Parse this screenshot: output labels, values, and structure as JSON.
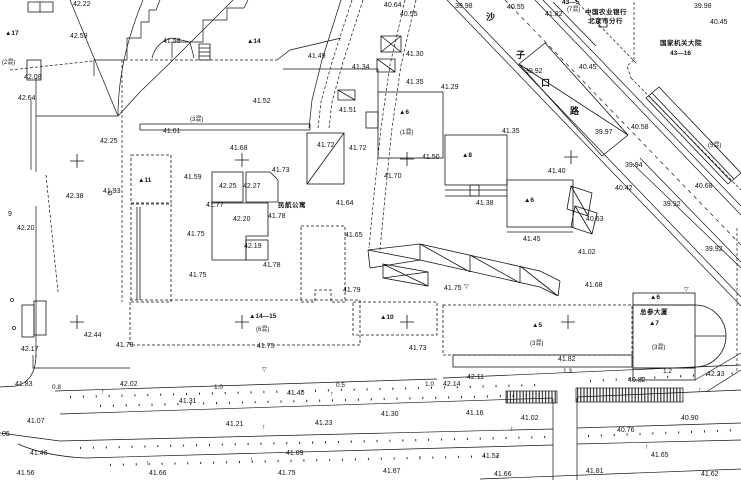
{
  "document": {
    "kind": "topographic-survey-drawing",
    "background_color": "#ffffff",
    "line_color": "#141414"
  },
  "names": {
    "bank_line1": "中国农业银行",
    "bank_line2": "北京市分行",
    "gov_compound": "国家机关大院",
    "gov_compound_no": "43—16",
    "apartment": "民航公寓",
    "tower": "总参大厦",
    "street_chars": [
      "沙",
      "子",
      "口",
      "路"
    ]
  },
  "labels": [
    {
      "t": "42.22",
      "x": 73,
      "y": 1,
      "c": "elev"
    },
    {
      "t": "42.59",
      "x": 70,
      "y": 33,
      "c": "elev"
    },
    {
      "t": "41.59",
      "x": 163,
      "y": 38,
      "c": "elev"
    },
    {
      "t": "42.08",
      "x": 24,
      "y": 74,
      "c": "elev"
    },
    {
      "t": "42.64",
      "x": 18,
      "y": 95,
      "c": "elev"
    },
    {
      "t": "42.25",
      "x": 100,
      "y": 138,
      "c": "elev"
    },
    {
      "t": "41.61",
      "x": 163,
      "y": 128,
      "c": "elev"
    },
    {
      "t": "42.38",
      "x": 66,
      "y": 193,
      "c": "elev"
    },
    {
      "t": "41.93",
      "x": 103,
      "y": 188,
      "c": "elev"
    },
    {
      "t": "42.20",
      "x": 17,
      "y": 225,
      "c": "elev"
    },
    {
      "t": "9",
      "x": 8,
      "y": 211,
      "c": "elev"
    },
    {
      "t": "41.68",
      "x": 230,
      "y": 145,
      "c": "elev"
    },
    {
      "t": "41.59",
      "x": 184,
      "y": 174,
      "c": "elev"
    },
    {
      "t": "41.73",
      "x": 272,
      "y": 167,
      "c": "elev"
    },
    {
      "t": "42.25",
      "x": 219,
      "y": 183,
      "c": "elev"
    },
    {
      "t": "42.27",
      "x": 243,
      "y": 183,
      "c": "elev"
    },
    {
      "t": "41.77",
      "x": 206,
      "y": 202,
      "c": "elev"
    },
    {
      "t": "42.20",
      "x": 233,
      "y": 216,
      "c": "elev"
    },
    {
      "t": "41.78",
      "x": 268,
      "y": 213,
      "c": "elev"
    },
    {
      "t": "41.75",
      "x": 187,
      "y": 231,
      "c": "elev"
    },
    {
      "t": "42.19",
      "x": 244,
      "y": 243,
      "c": "elev"
    },
    {
      "t": "41.78",
      "x": 263,
      "y": 262,
      "c": "elev"
    },
    {
      "t": "41.75",
      "x": 189,
      "y": 272,
      "c": "elev"
    },
    {
      "t": "41.64",
      "x": 336,
      "y": 200,
      "c": "elev"
    },
    {
      "t": "41.65",
      "x": 345,
      "y": 232,
      "c": "elev"
    },
    {
      "t": "41.79",
      "x": 343,
      "y": 287,
      "c": "elev"
    },
    {
      "t": "41.72",
      "x": 317,
      "y": 142,
      "c": "elev"
    },
    {
      "t": "41.72",
      "x": 349,
      "y": 145,
      "c": "elev"
    },
    {
      "t": "41.49",
      "x": 308,
      "y": 53,
      "c": "elev"
    },
    {
      "t": "41.52",
      "x": 253,
      "y": 98,
      "c": "elev"
    },
    {
      "t": "41.51",
      "x": 339,
      "y": 107,
      "c": "elev"
    },
    {
      "t": "41.34",
      "x": 352,
      "y": 64,
      "c": "elev"
    },
    {
      "t": "40.64",
      "x": 384,
      "y": 2,
      "c": "elev"
    },
    {
      "t": "40.55",
      "x": 400,
      "y": 11,
      "c": "elev"
    },
    {
      "t": "40.55",
      "x": 507,
      "y": 4,
      "c": "elev"
    },
    {
      "t": "41.82",
      "x": 545,
      "y": 11,
      "c": "elev"
    },
    {
      "t": "41.30",
      "x": 406,
      "y": 51,
      "c": "elev"
    },
    {
      "t": "41.35",
      "x": 406,
      "y": 79,
      "c": "elev"
    },
    {
      "t": "41.29",
      "x": 441,
      "y": 84,
      "c": "elev"
    },
    {
      "t": "41.35",
      "x": 502,
      "y": 128,
      "c": "elev"
    },
    {
      "t": "39.92",
      "x": 525,
      "y": 68,
      "c": "elev"
    },
    {
      "t": "39.98",
      "x": 455,
      "y": 3,
      "c": "elev"
    },
    {
      "t": "39.98",
      "x": 694,
      "y": 3,
      "c": "elev"
    },
    {
      "t": "40.45",
      "x": 579,
      "y": 64,
      "c": "elev"
    },
    {
      "t": "40.45",
      "x": 710,
      "y": 19,
      "c": "elev"
    },
    {
      "t": "39.97",
      "x": 595,
      "y": 129,
      "c": "elev"
    },
    {
      "t": "39.94",
      "x": 625,
      "y": 162,
      "c": "elev"
    },
    {
      "t": "40.58",
      "x": 631,
      "y": 124,
      "c": "elev"
    },
    {
      "t": "40.42",
      "x": 615,
      "y": 185,
      "c": "elev"
    },
    {
      "t": "40.63",
      "x": 586,
      "y": 216,
      "c": "elev"
    },
    {
      "t": "39.92",
      "x": 663,
      "y": 201,
      "c": "elev"
    },
    {
      "t": "39.92",
      "x": 705,
      "y": 246,
      "c": "elev"
    },
    {
      "t": "40.68",
      "x": 695,
      "y": 183,
      "c": "elev"
    },
    {
      "t": "41.02",
      "x": 578,
      "y": 249,
      "c": "elev"
    },
    {
      "t": "41.68",
      "x": 585,
      "y": 282,
      "c": "elev"
    },
    {
      "t": "41.50",
      "x": 422,
      "y": 154,
      "c": "elev"
    },
    {
      "t": "41.38",
      "x": 476,
      "y": 200,
      "c": "elev"
    },
    {
      "t": "41.40",
      "x": 548,
      "y": 168,
      "c": "elev"
    },
    {
      "t": "41.45",
      "x": 523,
      "y": 236,
      "c": "elev"
    },
    {
      "t": "41.75",
      "x": 444,
      "y": 285,
      "c": "elev"
    },
    {
      "t": "41.70",
      "x": 384,
      "y": 173,
      "c": "elev"
    },
    {
      "t": "42.17",
      "x": 21,
      "y": 346,
      "c": "elev"
    },
    {
      "t": "42.44",
      "x": 84,
      "y": 332,
      "c": "elev"
    },
    {
      "t": "41.78",
      "x": 116,
      "y": 342,
      "c": "elev"
    },
    {
      "t": "41.75",
      "x": 257,
      "y": 343,
      "c": "elev"
    },
    {
      "t": "41.73",
      "x": 409,
      "y": 345,
      "c": "elev"
    },
    {
      "t": "41.82",
      "x": 558,
      "y": 356,
      "c": "elev"
    },
    {
      "t": "41.83",
      "x": 15,
      "y": 381,
      "c": "elev"
    },
    {
      "t": "42.02",
      "x": 120,
      "y": 381,
      "c": "elev"
    },
    {
      "t": "41.31",
      "x": 179,
      "y": 398,
      "c": "elev"
    },
    {
      "t": "41.07",
      "x": 27,
      "y": 418,
      "c": "elev"
    },
    {
      "t": "41.21",
      "x": 226,
      "y": 421,
      "c": "elev"
    },
    {
      "t": "41.23",
      "x": 315,
      "y": 420,
      "c": "elev"
    },
    {
      "t": "41.40",
      "x": 287,
      "y": 390,
      "c": "elev"
    },
    {
      "t": "41.30",
      "x": 381,
      "y": 411,
      "c": "elev"
    },
    {
      "t": "41.16",
      "x": 466,
      "y": 410,
      "c": "elev"
    },
    {
      "t": "42.14",
      "x": 443,
      "y": 381,
      "c": "elev"
    },
    {
      "t": "42.11",
      "x": 467,
      "y": 374,
      "c": "elev"
    },
    {
      "t": "40.82",
      "x": 628,
      "y": 377,
      "c": "elev"
    },
    {
      "t": "42.23",
      "x": 707,
      "y": 371,
      "c": "elev"
    },
    {
      "t": "41.02",
      "x": 521,
      "y": 415,
      "c": "elev"
    },
    {
      "t": "40.90",
      "x": 681,
      "y": 415,
      "c": "elev"
    },
    {
      "t": "40.76",
      "x": 617,
      "y": 427,
      "c": "elev"
    },
    {
      "t": "41.46",
      "x": 30,
      "y": 450,
      "c": "elev"
    },
    {
      "t": "41.89",
      "x": 286,
      "y": 450,
      "c": "elev"
    },
    {
      "t": "41.56",
      "x": 17,
      "y": 470,
      "c": "elev"
    },
    {
      "t": "41.66",
      "x": 149,
      "y": 470,
      "c": "elev"
    },
    {
      "t": "41.75",
      "x": 278,
      "y": 470,
      "c": "elev"
    },
    {
      "t": "41.87",
      "x": 383,
      "y": 468,
      "c": "elev"
    },
    {
      "t": "41.52",
      "x": 482,
      "y": 453,
      "c": "elev"
    },
    {
      "t": "41.65",
      "x": 651,
      "y": 452,
      "c": "elev"
    },
    {
      "t": "41.66",
      "x": 494,
      "y": 471,
      "c": "elev"
    },
    {
      "t": "41.81",
      "x": 586,
      "y": 468,
      "c": "elev"
    },
    {
      "t": "41.62",
      "x": 701,
      "y": 471,
      "c": "elev"
    },
    {
      "t": ".05",
      "x": 0,
      "y": 431,
      "c": "elev"
    },
    {
      "t": "▲17",
      "x": 5,
      "y": 31,
      "c": "bld"
    },
    {
      "t": "▲14",
      "x": 247,
      "y": 39,
      "c": "bld"
    },
    {
      "t": "▲11",
      "x": 138,
      "y": 178,
      "c": "bld"
    },
    {
      "t": "▲14—15",
      "x": 249,
      "y": 314,
      "c": "bld"
    },
    {
      "t": "▲10",
      "x": 380,
      "y": 315,
      "c": "bld"
    },
    {
      "t": "▲5",
      "x": 532,
      "y": 323,
      "c": "bld"
    },
    {
      "t": "▲6",
      "x": 399,
      "y": 110,
      "c": "bld"
    },
    {
      "t": "▲8",
      "x": 462,
      "y": 153,
      "c": "bld"
    },
    {
      "t": "▲6",
      "x": 524,
      "y": 198,
      "c": "bld"
    },
    {
      "t": "▲7",
      "x": 649,
      "y": 321,
      "c": "bld"
    },
    {
      "t": "▲6",
      "x": 650,
      "y": 295,
      "c": "bld"
    },
    {
      "t": "43—5",
      "x": 562,
      "y": 0,
      "c": "bld"
    },
    {
      "t": "43—16",
      "x": 670,
      "y": 51,
      "c": "bld"
    },
    {
      "t": "(2混)",
      "x": 2,
      "y": 60,
      "c": "ann"
    },
    {
      "t": "(3混)",
      "x": 190,
      "y": 117,
      "c": "ann"
    },
    {
      "t": "(6混)",
      "x": 256,
      "y": 327,
      "c": "ann"
    },
    {
      "t": "(1混)",
      "x": 400,
      "y": 130,
      "c": "ann"
    },
    {
      "t": "(7混)",
      "x": 567,
      "y": 7,
      "c": "ann"
    },
    {
      "t": "(5混)",
      "x": 708,
      "y": 143,
      "c": "ann"
    },
    {
      "t": "(3混)",
      "x": 530,
      "y": 341,
      "c": "ann"
    },
    {
      "t": "(3混)",
      "x": 652,
      "y": 345,
      "c": "ann"
    },
    {
      "t": "中国农业银行",
      "x": 585,
      "y": 10,
      "c": "name"
    },
    {
      "t": "北京市分行",
      "x": 588,
      "y": 19,
      "c": "name"
    },
    {
      "t": "国家机关大院",
      "x": 660,
      "y": 41,
      "c": "name"
    },
    {
      "t": "民航公寓",
      "x": 278,
      "y": 203,
      "c": "name"
    },
    {
      "t": "总参大厦",
      "x": 640,
      "y": 310,
      "c": "name"
    },
    {
      "t": "沙",
      "x": 486,
      "y": 13,
      "c": "street"
    },
    {
      "t": "子",
      "x": 516,
      "y": 51,
      "c": "street"
    },
    {
      "t": "口",
      "x": 541,
      "y": 79,
      "c": "street"
    },
    {
      "t": "路",
      "x": 570,
      "y": 107,
      "c": "street"
    },
    {
      "t": "0.8",
      "x": 52,
      "y": 385,
      "c": "dim"
    },
    {
      "t": "1.0",
      "x": 214,
      "y": 385,
      "c": "dim"
    },
    {
      "t": "0.5",
      "x": 336,
      "y": 383,
      "c": "dim"
    },
    {
      "t": "1.0",
      "x": 425,
      "y": 382,
      "c": "dim"
    },
    {
      "t": "1.3",
      "x": 563,
      "y": 369,
      "c": "dim"
    },
    {
      "t": "1.2",
      "x": 663,
      "y": 369,
      "c": "dim"
    },
    {
      "t": "▽",
      "x": 464,
      "y": 284,
      "c": "sym"
    },
    {
      "t": "▽",
      "x": 684,
      "y": 287,
      "c": "sym"
    },
    {
      "t": "▽",
      "x": 262,
      "y": 367,
      "c": "sym"
    },
    {
      "t": "↑",
      "x": 101,
      "y": 389,
      "c": "tree"
    },
    {
      "t": "↑",
      "x": 146,
      "y": 460,
      "c": "tree"
    },
    {
      "t": "↑",
      "x": 250,
      "y": 457,
      "c": "tree"
    },
    {
      "t": "↑",
      "x": 330,
      "y": 391,
      "c": "tree"
    },
    {
      "t": "↑",
      "x": 510,
      "y": 426,
      "c": "tree"
    },
    {
      "t": "↑",
      "x": 645,
      "y": 444,
      "c": "tree"
    },
    {
      "t": "↑",
      "x": 698,
      "y": 387,
      "c": "tree"
    },
    {
      "t": "↑",
      "x": 418,
      "y": 455,
      "c": "tree"
    },
    {
      "t": "↑",
      "x": 262,
      "y": 424,
      "c": "tree"
    }
  ]
}
